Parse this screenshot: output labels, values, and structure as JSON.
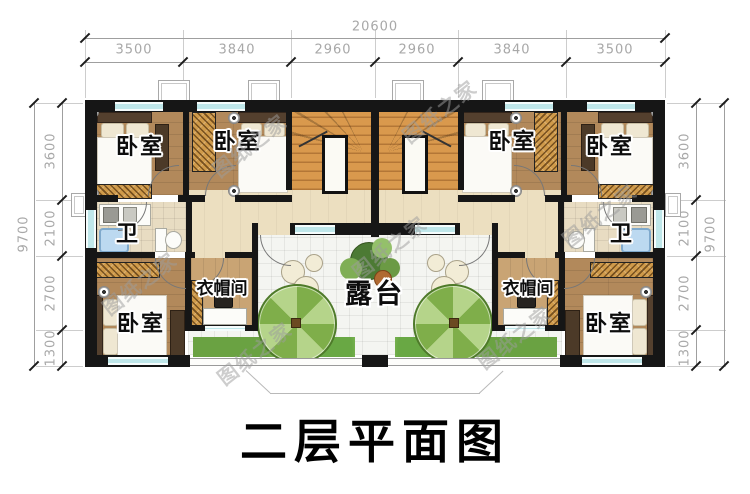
{
  "title": "二层平面图",
  "watermark": "图纸之家",
  "labels": {
    "bedroom": "卧室",
    "bath": "卫",
    "cloakroom": "衣帽间",
    "terrace": "露台"
  },
  "dims": {
    "top_total": "20600",
    "top_segments": [
      "3500",
      "3840",
      "2960",
      "2960",
      "3840",
      "3500"
    ],
    "side_total": "9700",
    "side_segments": [
      "3600",
      "2100",
      "2700",
      "1300"
    ]
  },
  "colors": {
    "wall": "#161616",
    "window": "#bfe7ea",
    "wood": "#b2895b",
    "wood-light": "#ecdfc0",
    "bath-tile": "#e8dcc2",
    "terrace-tile": "#f4f5f1",
    "stair": "#d9994d",
    "cloak-wood": "#c9a474",
    "hatch": "#cf9a4a",
    "parasol-a": "#7fae4a",
    "parasol-b": "#b5d48a",
    "shrub": "#6aa242",
    "dim": "#a8a8a8"
  }
}
